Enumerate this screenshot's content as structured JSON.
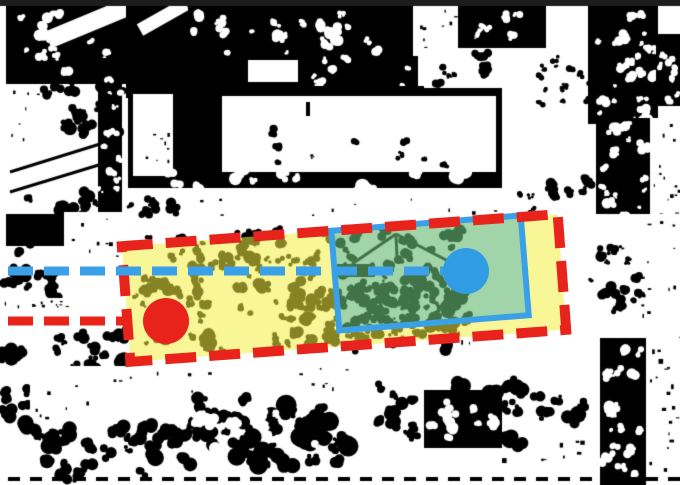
{
  "figure": {
    "kind": "binarized-aerial-photo-with-annotations",
    "width": 680,
    "height": 485,
    "colors": {
      "black": "#000000",
      "white": "#ffffff",
      "top_bar": "#1d1d1d",
      "annotation_red": "#e8231b",
      "annotation_blue": "#3aa0e8",
      "marker_blue": "#2f9ce4",
      "yellow_fill": "rgba(242,238,66,0.55)",
      "green_fill": "rgba(104,188,116,0.62)"
    }
  },
  "annotations": {
    "boundary_red": {
      "cx": 344,
      "cy": 288,
      "w": 437,
      "h": 116,
      "rot": -4.2,
      "color": "#e8231b",
      "stroke_width": 10,
      "dash": "31 13"
    },
    "fill_yellow": {
      "color": "rgba(242,238,66,0.55)"
    },
    "zone_blue": {
      "cx": 430,
      "cy": 273,
      "w": 190,
      "h": 100,
      "rot": -4.6,
      "border_color": "#3aa0e8",
      "border_width": 6,
      "fill_color": "rgba(104,188,116,0.62)"
    },
    "guide_blue": {
      "x1": 8,
      "y1": 271,
      "x2": 444,
      "y2": 271,
      "color": "#3aa0e8",
      "width": 9,
      "dash": "25 11"
    },
    "guide_red": {
      "x1": 8,
      "y1": 321,
      "x2": 131,
      "y2": 321,
      "color": "#e8231b",
      "width": 9,
      "dash": "25 11"
    },
    "marker_red": {
      "cx": 166,
      "cy": 321,
      "r": 23,
      "color": "#e8231b"
    },
    "marker_blue": {
      "cx": 466,
      "cy": 271,
      "r": 23,
      "color": "#2f9ce4"
    }
  },
  "scene": {
    "seed": 20240613,
    "features": [
      {
        "t": "rect",
        "x": 0,
        "y": 0,
        "w": 680,
        "h": 485,
        "c": "w"
      },
      {
        "t": "rect",
        "x": 6,
        "y": 6,
        "w": 122,
        "h": 78,
        "c": "k"
      },
      {
        "t": "blobs",
        "x": 20,
        "y": 14,
        "w": 95,
        "h": 60,
        "n": 14,
        "r0": 2,
        "r1": 6,
        "c": "w"
      },
      {
        "t": "line",
        "x1": 48,
        "y1": 40,
        "x2": 135,
        "y2": 4,
        "w": 18,
        "c": "w"
      },
      {
        "t": "rect",
        "x": 126,
        "y": 6,
        "w": 62,
        "h": 92,
        "c": "k"
      },
      {
        "t": "line",
        "x1": 140,
        "y1": 30,
        "x2": 186,
        "y2": 4,
        "w": 13,
        "c": "w"
      },
      {
        "t": "rect",
        "x": 188,
        "y": 6,
        "w": 225,
        "h": 52,
        "c": "k"
      },
      {
        "t": "blobs",
        "x": 195,
        "y": 10,
        "w": 215,
        "h": 45,
        "n": 22,
        "r0": 2,
        "r1": 7,
        "c": "w"
      },
      {
        "t": "rect",
        "x": 188,
        "y": 56,
        "w": 230,
        "h": 34,
        "c": "k"
      },
      {
        "t": "rect",
        "x": 248,
        "y": 60,
        "w": 50,
        "h": 22,
        "c": "w"
      },
      {
        "t": "blobs",
        "x": 300,
        "y": 58,
        "w": 110,
        "h": 28,
        "n": 8,
        "r0": 2,
        "r1": 5,
        "c": "w"
      },
      {
        "t": "rect",
        "x": 413,
        "y": 6,
        "w": 45,
        "h": 48,
        "c": "w"
      },
      {
        "t": "specks",
        "x": 415,
        "y": 8,
        "w": 42,
        "h": 44,
        "n": 8,
        "s": 3,
        "c": "k"
      },
      {
        "t": "rect",
        "x": 458,
        "y": 6,
        "w": 88,
        "h": 58,
        "c": "k"
      },
      {
        "t": "blobs",
        "x": 462,
        "y": 10,
        "w": 80,
        "h": 50,
        "n": 14,
        "r0": 2,
        "r1": 5,
        "c": "w"
      },
      {
        "t": "rect",
        "x": 548,
        "y": 6,
        "w": 40,
        "h": 52,
        "c": "w"
      },
      {
        "t": "rect",
        "x": 588,
        "y": 6,
        "w": 70,
        "h": 118,
        "c": "k"
      },
      {
        "t": "blobs",
        "x": 592,
        "y": 12,
        "w": 62,
        "h": 108,
        "n": 26,
        "r0": 2,
        "r1": 6,
        "c": "w"
      },
      {
        "t": "rect",
        "x": 658,
        "y": 6,
        "w": 22,
        "h": 28,
        "c": "w"
      },
      {
        "t": "rect",
        "x": 656,
        "y": 34,
        "w": 24,
        "h": 72,
        "c": "k"
      },
      {
        "t": "blobs",
        "x": 658,
        "y": 40,
        "w": 20,
        "h": 62,
        "n": 8,
        "r0": 2,
        "r1": 4,
        "c": "w"
      },
      {
        "t": "rect",
        "x": 6,
        "y": 84,
        "w": 38,
        "h": 84,
        "c": "w"
      },
      {
        "t": "specks",
        "x": 8,
        "y": 88,
        "w": 34,
        "h": 78,
        "n": 10,
        "s": 3,
        "c": "k"
      },
      {
        "t": "blobs",
        "x": 38,
        "y": 82,
        "w": 88,
        "h": 52,
        "n": 18,
        "r0": 3,
        "r1": 8,
        "c": "k"
      },
      {
        "t": "rect",
        "x": 6,
        "y": 148,
        "w": 100,
        "h": 44,
        "c": "w"
      },
      {
        "t": "line",
        "x1": 10,
        "y1": 172,
        "x2": 100,
        "y2": 144,
        "w": 3,
        "c": "k"
      },
      {
        "t": "line",
        "x1": 10,
        "y1": 192,
        "x2": 102,
        "y2": 164,
        "w": 3,
        "c": "k"
      },
      {
        "t": "rect",
        "x": 98,
        "y": 58,
        "w": 24,
        "h": 182,
        "c": "k"
      },
      {
        "t": "blobs",
        "x": 100,
        "y": 66,
        "w": 20,
        "h": 168,
        "n": 16,
        "r0": 2,
        "r1": 5,
        "c": "w"
      },
      {
        "t": "blobs",
        "x": 28,
        "y": 192,
        "w": 84,
        "h": 52,
        "n": 18,
        "r0": 3,
        "r1": 8,
        "c": "k"
      },
      {
        "t": "rect",
        "x": 128,
        "y": 86,
        "w": 374,
        "h": 102,
        "c": "k"
      },
      {
        "t": "rect",
        "x": 133,
        "y": 94,
        "w": 40,
        "h": 82,
        "c": "w"
      },
      {
        "t": "specks",
        "x": 135,
        "y": 98,
        "w": 36,
        "h": 74,
        "n": 8,
        "s": 3,
        "c": "k"
      },
      {
        "t": "rect",
        "x": 222,
        "y": 96,
        "w": 274,
        "h": 76,
        "c": "w"
      },
      {
        "t": "blobs",
        "x": 250,
        "y": 128,
        "w": 220,
        "h": 38,
        "n": 9,
        "r0": 2,
        "r1": 5,
        "c": "k"
      },
      {
        "t": "rect",
        "x": 306,
        "y": 102,
        "w": 4,
        "h": 14,
        "c": "k"
      },
      {
        "t": "rect",
        "x": 424,
        "y": 48,
        "w": 132,
        "h": 40,
        "c": "w"
      },
      {
        "t": "blobs",
        "x": 430,
        "y": 52,
        "w": 120,
        "h": 34,
        "n": 12,
        "r0": 2,
        "r1": 5,
        "c": "k"
      },
      {
        "t": "rect",
        "x": 502,
        "y": 60,
        "w": 86,
        "h": 112,
        "c": "w"
      },
      {
        "t": "blobs",
        "x": 540,
        "y": 58,
        "w": 55,
        "h": 50,
        "n": 14,
        "r0": 2,
        "r1": 4,
        "c": "k"
      },
      {
        "t": "blobs",
        "x": 140,
        "y": 172,
        "w": 360,
        "h": 24,
        "n": 12,
        "r0": 3,
        "r1": 8,
        "c": "w"
      },
      {
        "t": "blobs",
        "x": 130,
        "y": 196,
        "w": 60,
        "h": 22,
        "n": 8,
        "r0": 3,
        "r1": 6,
        "c": "k"
      },
      {
        "t": "specks",
        "x": 200,
        "y": 198,
        "w": 300,
        "h": 18,
        "n": 10,
        "s": 3,
        "c": "k"
      },
      {
        "t": "rect",
        "x": 596,
        "y": 118,
        "w": 54,
        "h": 142,
        "c": "k"
      },
      {
        "t": "blobs",
        "x": 600,
        "y": 124,
        "w": 46,
        "h": 130,
        "n": 22,
        "r0": 2,
        "r1": 6,
        "c": "w"
      },
      {
        "t": "rect",
        "x": 650,
        "y": 118,
        "w": 30,
        "h": 142,
        "c": "w"
      },
      {
        "t": "specks",
        "x": 652,
        "y": 122,
        "w": 26,
        "h": 134,
        "n": 20,
        "s": 3,
        "c": "k"
      },
      {
        "t": "rect",
        "x": 508,
        "y": 172,
        "w": 88,
        "h": 56,
        "c": "w"
      },
      {
        "t": "blobs",
        "x": 515,
        "y": 178,
        "w": 76,
        "h": 44,
        "n": 12,
        "r0": 2,
        "r1": 6,
        "c": "k"
      },
      {
        "t": "rect",
        "x": 6,
        "y": 214,
        "w": 58,
        "h": 32,
        "c": "k"
      },
      {
        "t": "rect",
        "x": 64,
        "y": 212,
        "w": 62,
        "h": 48,
        "c": "w"
      },
      {
        "t": "specks",
        "x": 66,
        "y": 216,
        "w": 58,
        "h": 42,
        "n": 8,
        "s": 3,
        "c": "k"
      },
      {
        "t": "blobs",
        "x": 8,
        "y": 252,
        "w": 58,
        "h": 52,
        "n": 14,
        "r0": 3,
        "r1": 7,
        "c": "k"
      },
      {
        "t": "rect",
        "x": 6,
        "y": 298,
        "w": 122,
        "h": 22,
        "c": "w"
      },
      {
        "t": "specks",
        "x": 16,
        "y": 300,
        "w": 50,
        "h": 6,
        "n": 12,
        "s": 2,
        "c": "k"
      },
      {
        "t": "blobs",
        "x": 52,
        "y": 328,
        "w": 78,
        "h": 42,
        "n": 16,
        "r0": 3,
        "r1": 7,
        "c": "k"
      },
      {
        "t": "blobs",
        "x": 135,
        "y": 232,
        "w": 330,
        "h": 118,
        "n": 150,
        "r0": 2,
        "r1": 7,
        "c": "k"
      },
      {
        "t": "line",
        "x1": 352,
        "y1": 264,
        "x2": 396,
        "y2": 234,
        "w": 3,
        "c": "k"
      },
      {
        "t": "line",
        "x1": 396,
        "y1": 234,
        "x2": 450,
        "y2": 262,
        "w": 3,
        "c": "k"
      },
      {
        "t": "line",
        "x1": 396,
        "y1": 236,
        "x2": 397,
        "y2": 256,
        "w": 3,
        "c": "k"
      },
      {
        "t": "blobs",
        "x": 392,
        "y": 268,
        "w": 80,
        "h": 58,
        "n": 26,
        "r0": 3,
        "r1": 8,
        "c": "k"
      },
      {
        "t": "rect",
        "x": 333,
        "y": 264,
        "w": 42,
        "h": 13,
        "c": "k"
      },
      {
        "t": "blobs",
        "x": 352,
        "y": 286,
        "w": 70,
        "h": 48,
        "n": 20,
        "r0": 3,
        "r1": 7,
        "c": "k"
      },
      {
        "t": "line",
        "x1": 430,
        "y1": 322,
        "x2": 458,
        "y2": 284,
        "w": 4,
        "c": "k"
      },
      {
        "t": "blobs",
        "x": 295,
        "y": 300,
        "w": 65,
        "h": 42,
        "n": 14,
        "r0": 3,
        "r1": 6,
        "c": "k"
      },
      {
        "t": "specks",
        "x": 322,
        "y": 330,
        "w": 148,
        "h": 12,
        "n": 16,
        "s": 4,
        "c": "k"
      },
      {
        "t": "rect",
        "x": 566,
        "y": 214,
        "w": 114,
        "h": 152,
        "c": "w"
      },
      {
        "t": "blobs",
        "x": 580,
        "y": 246,
        "w": 70,
        "h": 66,
        "n": 20,
        "r0": 2,
        "r1": 6,
        "c": "k"
      },
      {
        "t": "specks",
        "x": 640,
        "y": 220,
        "w": 40,
        "h": 140,
        "n": 16,
        "s": 3,
        "c": "k"
      },
      {
        "t": "blobs",
        "x": 0,
        "y": 352,
        "w": 48,
        "h": 70,
        "n": 14,
        "r0": 3,
        "r1": 8,
        "c": "k"
      },
      {
        "t": "rect",
        "x": 30,
        "y": 366,
        "w": 112,
        "h": 58,
        "c": "w"
      },
      {
        "t": "specks",
        "x": 34,
        "y": 370,
        "w": 104,
        "h": 50,
        "n": 10,
        "s": 3,
        "c": "k"
      },
      {
        "t": "blobs",
        "x": 30,
        "y": 424,
        "w": 115,
        "h": 58,
        "n": 20,
        "r0": 3,
        "r1": 9,
        "c": "k"
      },
      {
        "t": "rect",
        "x": 132,
        "y": 362,
        "w": 230,
        "h": 36,
        "c": "w"
      },
      {
        "t": "specks",
        "x": 140,
        "y": 366,
        "w": 215,
        "h": 30,
        "n": 12,
        "s": 3,
        "c": "k"
      },
      {
        "t": "blobs",
        "x": 148,
        "y": 396,
        "w": 205,
        "h": 68,
        "n": 40,
        "r0": 4,
        "r1": 11,
        "c": "k"
      },
      {
        "t": "blobs",
        "x": 180,
        "y": 410,
        "w": 140,
        "h": 40,
        "n": 10,
        "r0": 3,
        "r1": 7,
        "c": "w"
      },
      {
        "t": "blobs",
        "x": 380,
        "y": 384,
        "w": 205,
        "h": 58,
        "n": 30,
        "r0": 4,
        "r1": 10,
        "c": "k"
      },
      {
        "t": "rect",
        "x": 424,
        "y": 390,
        "w": 78,
        "h": 58,
        "c": "k"
      },
      {
        "t": "blobs",
        "x": 432,
        "y": 396,
        "w": 62,
        "h": 46,
        "n": 10,
        "r0": 3,
        "r1": 6,
        "c": "w"
      },
      {
        "t": "specks",
        "x": 500,
        "y": 440,
        "w": 90,
        "h": 30,
        "n": 8,
        "s": 4,
        "c": "k"
      },
      {
        "t": "rect",
        "x": 600,
        "y": 338,
        "w": 46,
        "h": 147,
        "c": "k"
      },
      {
        "t": "blobs",
        "x": 604,
        "y": 346,
        "w": 38,
        "h": 130,
        "n": 20,
        "r0": 2,
        "r1": 6,
        "c": "w"
      },
      {
        "t": "rect",
        "x": 646,
        "y": 338,
        "w": 34,
        "h": 147,
        "c": "w"
      },
      {
        "t": "specks",
        "x": 648,
        "y": 344,
        "w": 30,
        "h": 136,
        "n": 18,
        "s": 4,
        "c": "k"
      },
      {
        "t": "rect",
        "x": 0,
        "y": 0,
        "w": 680,
        "h": 6,
        "c": "#1d1d1d"
      },
      {
        "t": "dashrow",
        "y": 477,
        "x0": 8,
        "x1": 672,
        "step": 22,
        "w": 12,
        "h": 4,
        "c": "k"
      }
    ]
  }
}
